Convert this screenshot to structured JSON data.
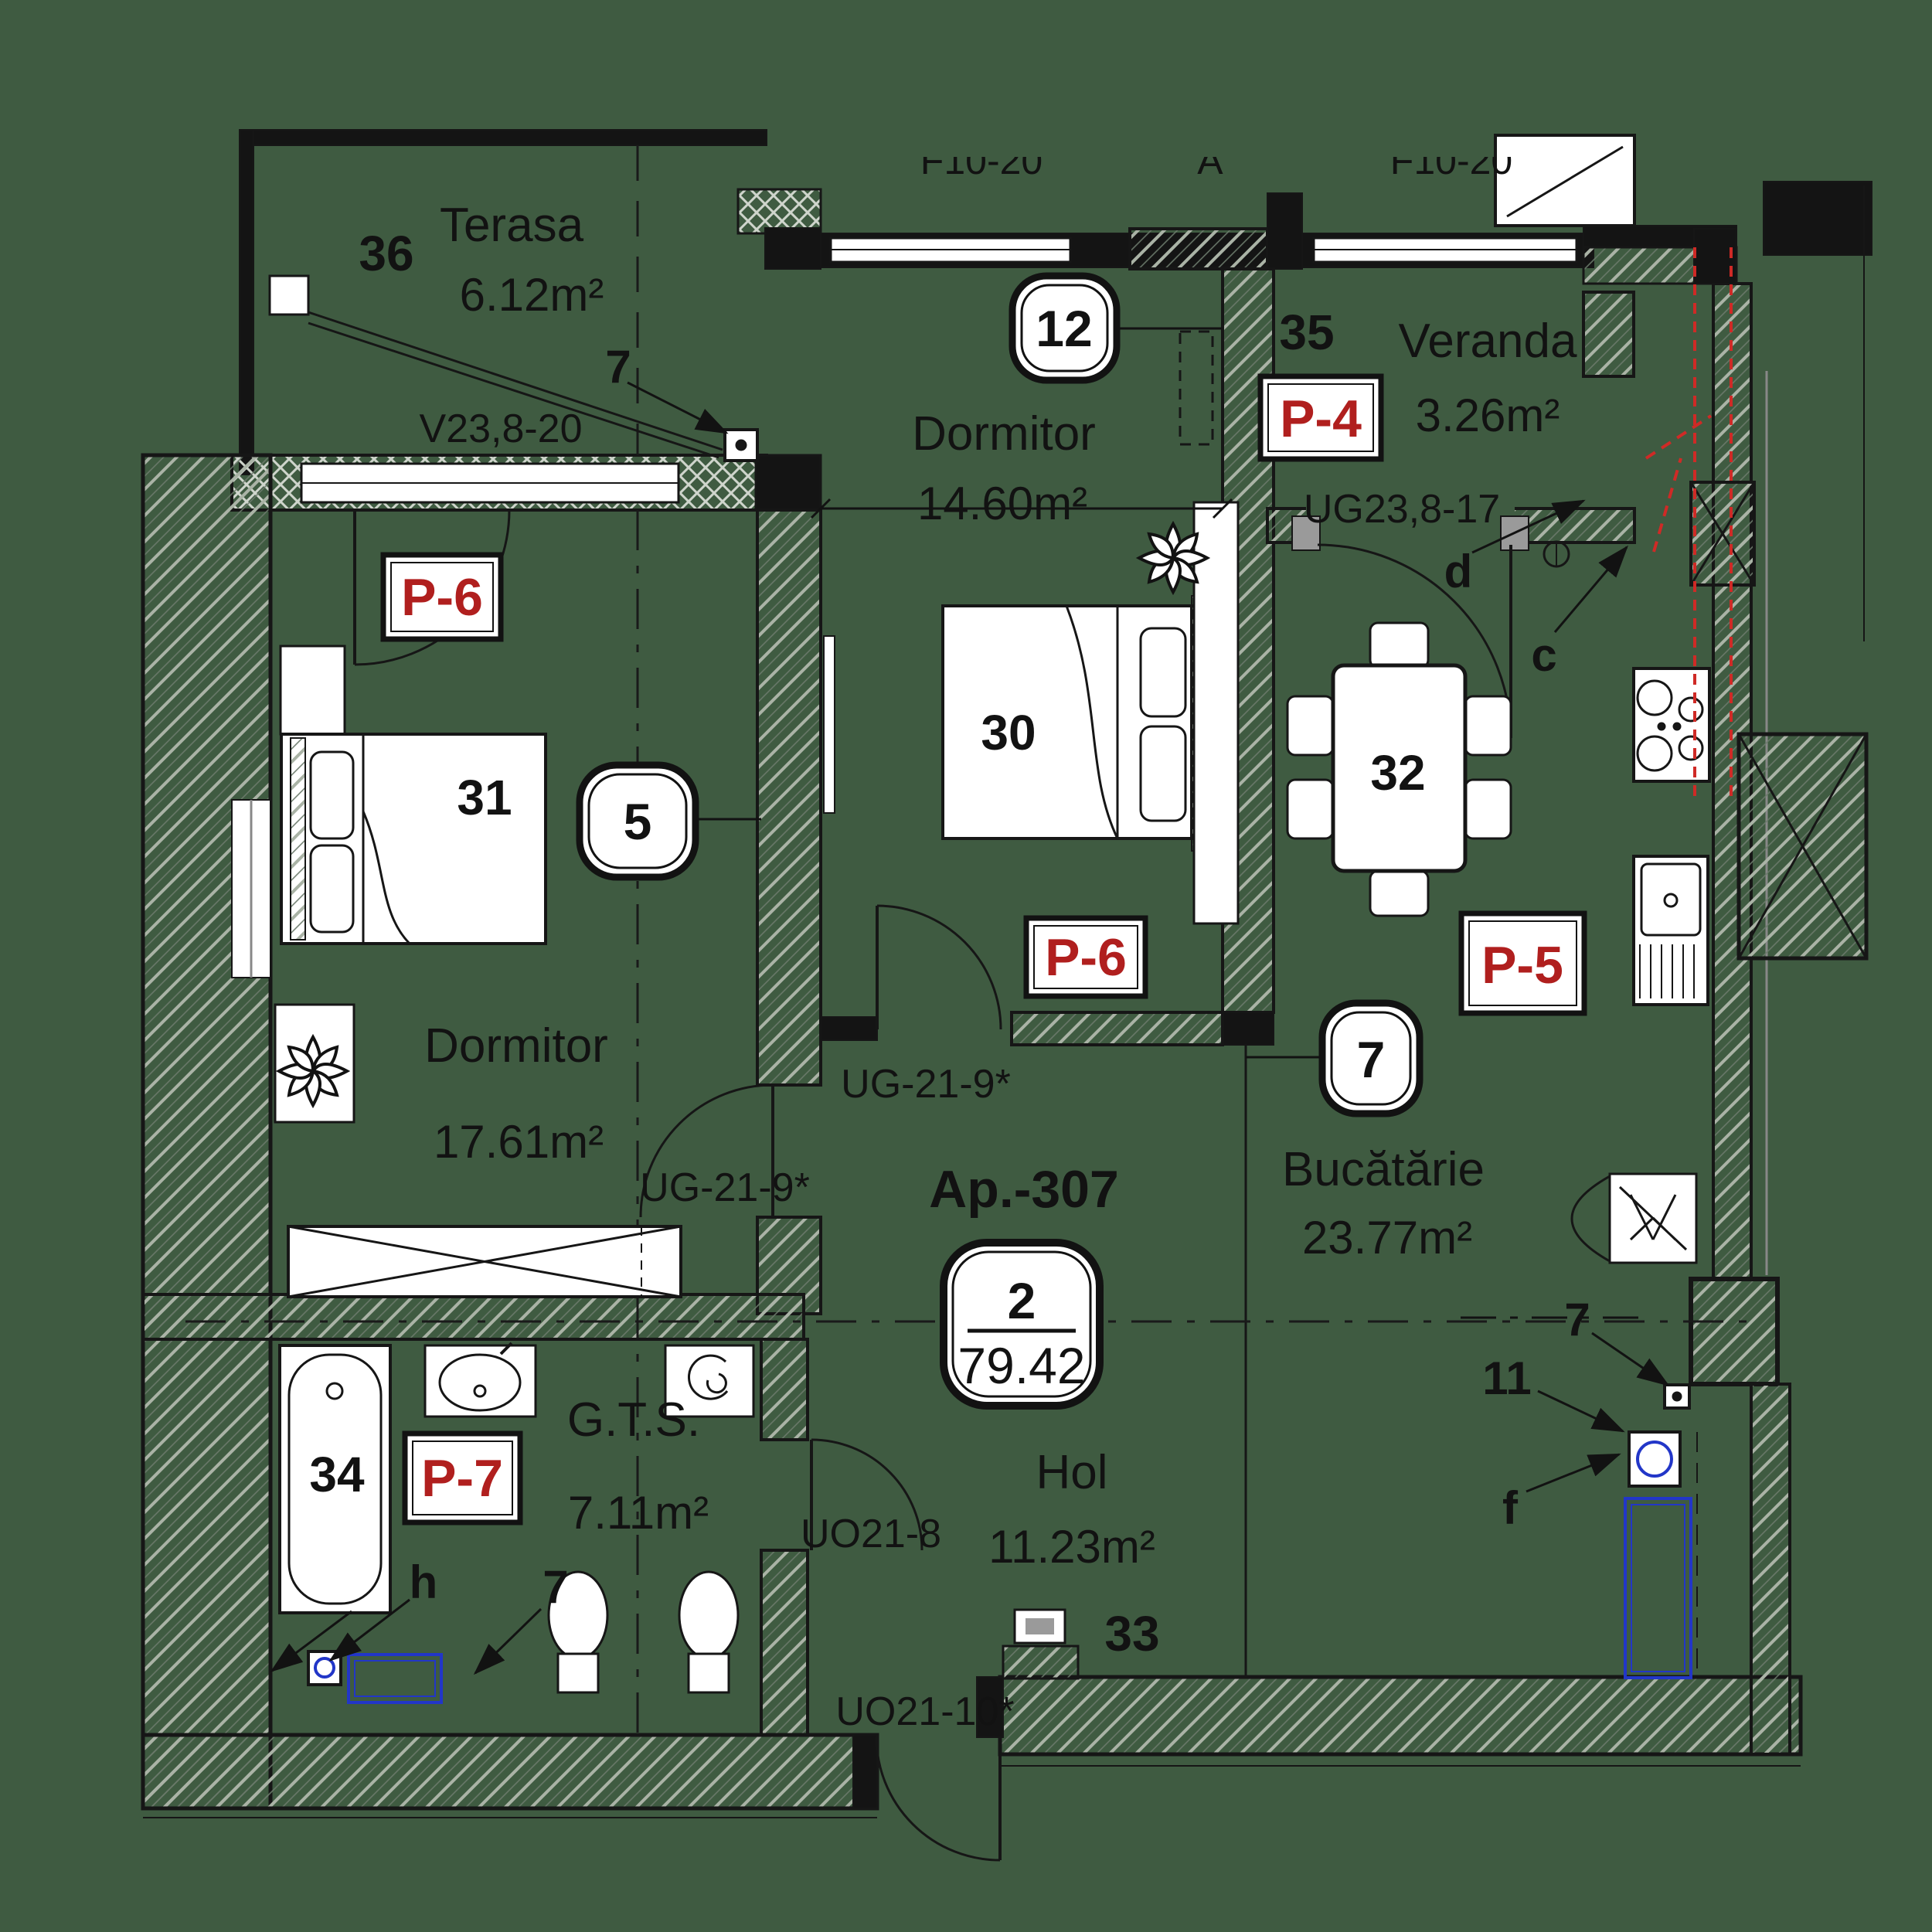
{
  "plan": {
    "type": "apartment-floor-plan",
    "background_color": "#3f5b41",
    "accent_red": "#b01f1e",
    "duct_blue": "#2236c8",
    "apartment": {
      "id": "Ap.-307",
      "rooms_count": "2",
      "total_area": "79.42"
    },
    "rooms": [
      {
        "key": "terasa",
        "number": "36",
        "name": "Terasa",
        "area": "6.12m²"
      },
      {
        "key": "dormitor31",
        "number": "31",
        "name": "Dormitor",
        "area": "17.61m²"
      },
      {
        "key": "dormitor30",
        "number": "30",
        "name": "Dormitor",
        "area": "14.60m²"
      },
      {
        "key": "veranda",
        "number": "35",
        "name": "Veranda",
        "area": "3.26m²"
      },
      {
        "key": "bucatarie",
        "number": "32",
        "name": "Bucătărie",
        "area": "23.77m²"
      },
      {
        "key": "hol",
        "number": "33",
        "name": "Hol",
        "area": "11.23m²"
      },
      {
        "key": "gts",
        "number": "34",
        "name": "G.T.S.",
        "area": "7.11m²"
      }
    ],
    "finish_labels": {
      "p4": "P-4",
      "p5": "P-5",
      "p6_dormitor31": "P-6",
      "p6_dormitor30": "P-6",
      "p7": "P-7"
    },
    "opening_codes": {
      "terasa_window": "V23,8-20",
      "veranda_door": "UG23,8-17",
      "dormitor31_door": "UG-21-9*",
      "dormitor30_door": "UG-21-9*",
      "gts_door": "UO21-8",
      "entrance_door": "UO21-10*"
    },
    "callouts": {
      "window_5": "5",
      "window_12": "12",
      "kitchen_7": "7",
      "terasa_7": "7",
      "gts_7": "7",
      "kitchen_right_7": "7",
      "shaft_11": "11",
      "letter_c": "c",
      "letter_d": "d",
      "letter_f": "f",
      "letter_h": "h"
    },
    "clipped_top_labels": {
      "left": "F10-20",
      "mid": "\"A\"",
      "right": "F10-20"
    }
  }
}
